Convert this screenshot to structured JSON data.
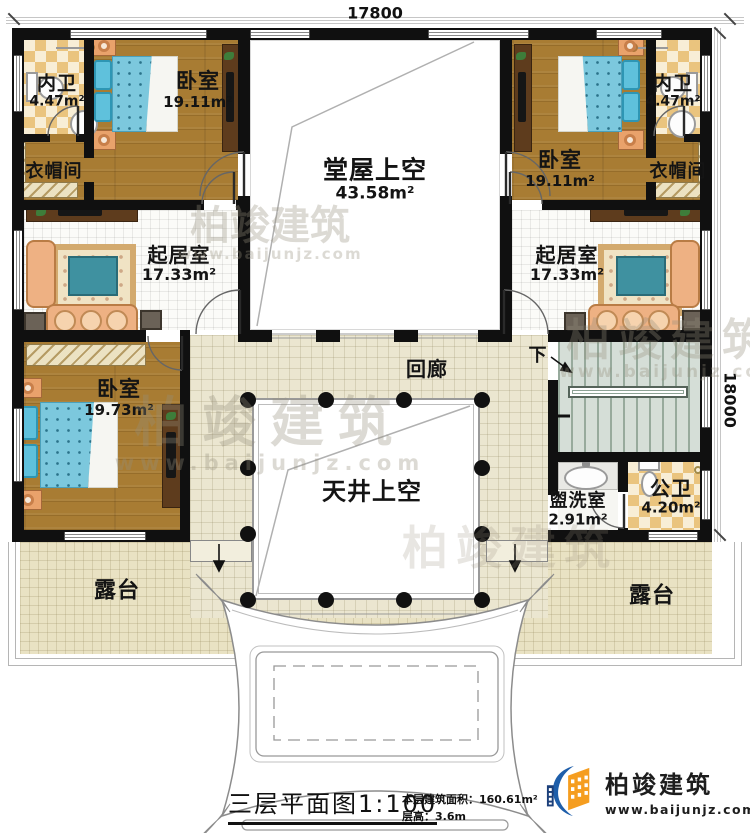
{
  "dimensions": {
    "width": "17800",
    "height": "18000"
  },
  "rooms": {
    "bath_left": {
      "name": "内卫",
      "area": "4.47m²"
    },
    "bedroom_top_left": {
      "name": "卧室",
      "area": "19.11m²"
    },
    "cloak_left": {
      "name": "衣帽间"
    },
    "living_left": {
      "name": "起居室",
      "area": "17.33m²"
    },
    "hall_void": {
      "name": "堂屋上空",
      "area": "43.58m²"
    },
    "bedroom_top_right": {
      "name": "卧室",
      "area": "19.11m²"
    },
    "bath_right": {
      "name": "内卫",
      "area": "4.47m²"
    },
    "cloak_right": {
      "name": "衣帽间"
    },
    "living_right": {
      "name": "起居室",
      "area": "17.33m²"
    },
    "bedroom_bottom_left": {
      "name": "卧室",
      "area": "19.73m²"
    },
    "corridor": {
      "name": "回廊"
    },
    "courtyard_void": {
      "name": "天井上空"
    },
    "washroom": {
      "name": "盥洗室",
      "area": "2.91m²"
    },
    "public_bath": {
      "name": "公卫",
      "area": "4.20m²"
    },
    "terrace_left": {
      "name": "露台"
    },
    "terrace_right": {
      "name": "露台"
    }
  },
  "stairs": {
    "down_label": "下"
  },
  "title_block": {
    "title": "三层平面图",
    "scale": "1:100",
    "area_label": "本层建筑面积：",
    "area_value": "160.61m²",
    "floor_height_label": "层高：",
    "floor_height_value": "3.6m"
  },
  "logo": {
    "name": "柏竣建筑",
    "url": "www.baijunjz.com"
  },
  "watermark": {
    "text": "柏竣建筑",
    "url": "www.baijunjz.com"
  },
  "colors": {
    "wall": "#101010",
    "wood_floor": "#a87c33",
    "checker_tile": "#eac47e",
    "bed_blue": "#7cc8dd",
    "sofa_orange": "#eeb183",
    "corridor_floor": "#ebe6d0",
    "terrace_floor": "#e9e2c3",
    "stairs_floor": "#d5ded7",
    "logo_blue": "#1e5eaa",
    "logo_orange": "#f59d1f",
    "watermark_gray": "#968e7d"
  }
}
